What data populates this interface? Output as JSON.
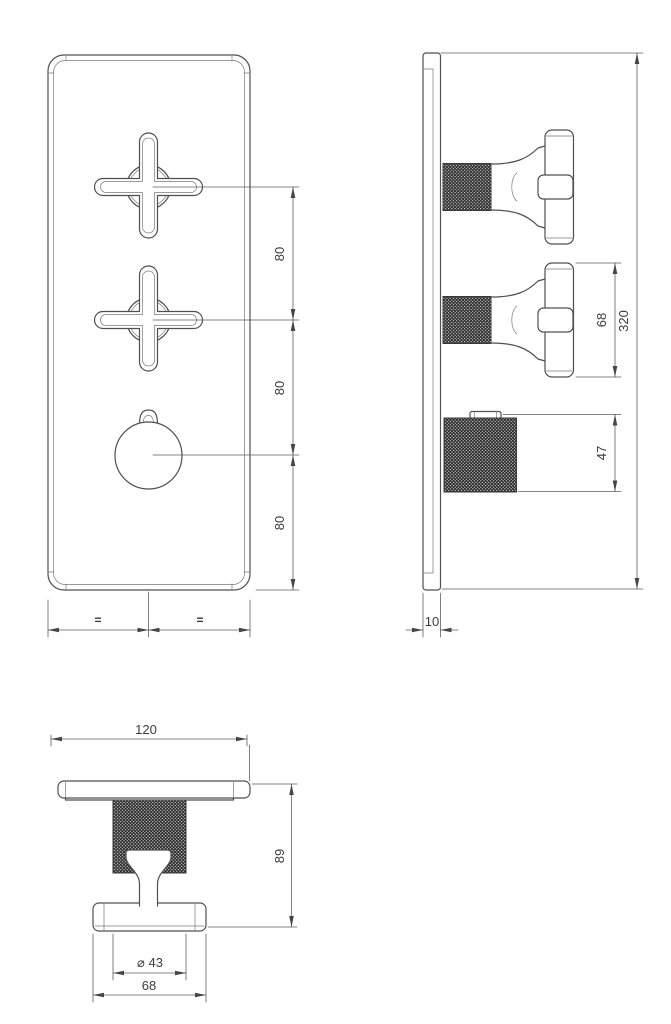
{
  "front_view": {
    "dim_spacing_top": "80",
    "dim_spacing_middle": "80",
    "dim_spacing_bottom": "80",
    "equal_left": "=",
    "equal_right": "="
  },
  "side_view": {
    "dim_total_height": "320",
    "dim_handle_height": "68",
    "dim_knob_height": "47",
    "dim_plate_thickness": "10"
  },
  "bottom_view": {
    "dim_plate_width": "120",
    "dim_total_depth": "89",
    "dim_knob_diameter": "⌀ 43",
    "dim_handle_length": "68"
  }
}
